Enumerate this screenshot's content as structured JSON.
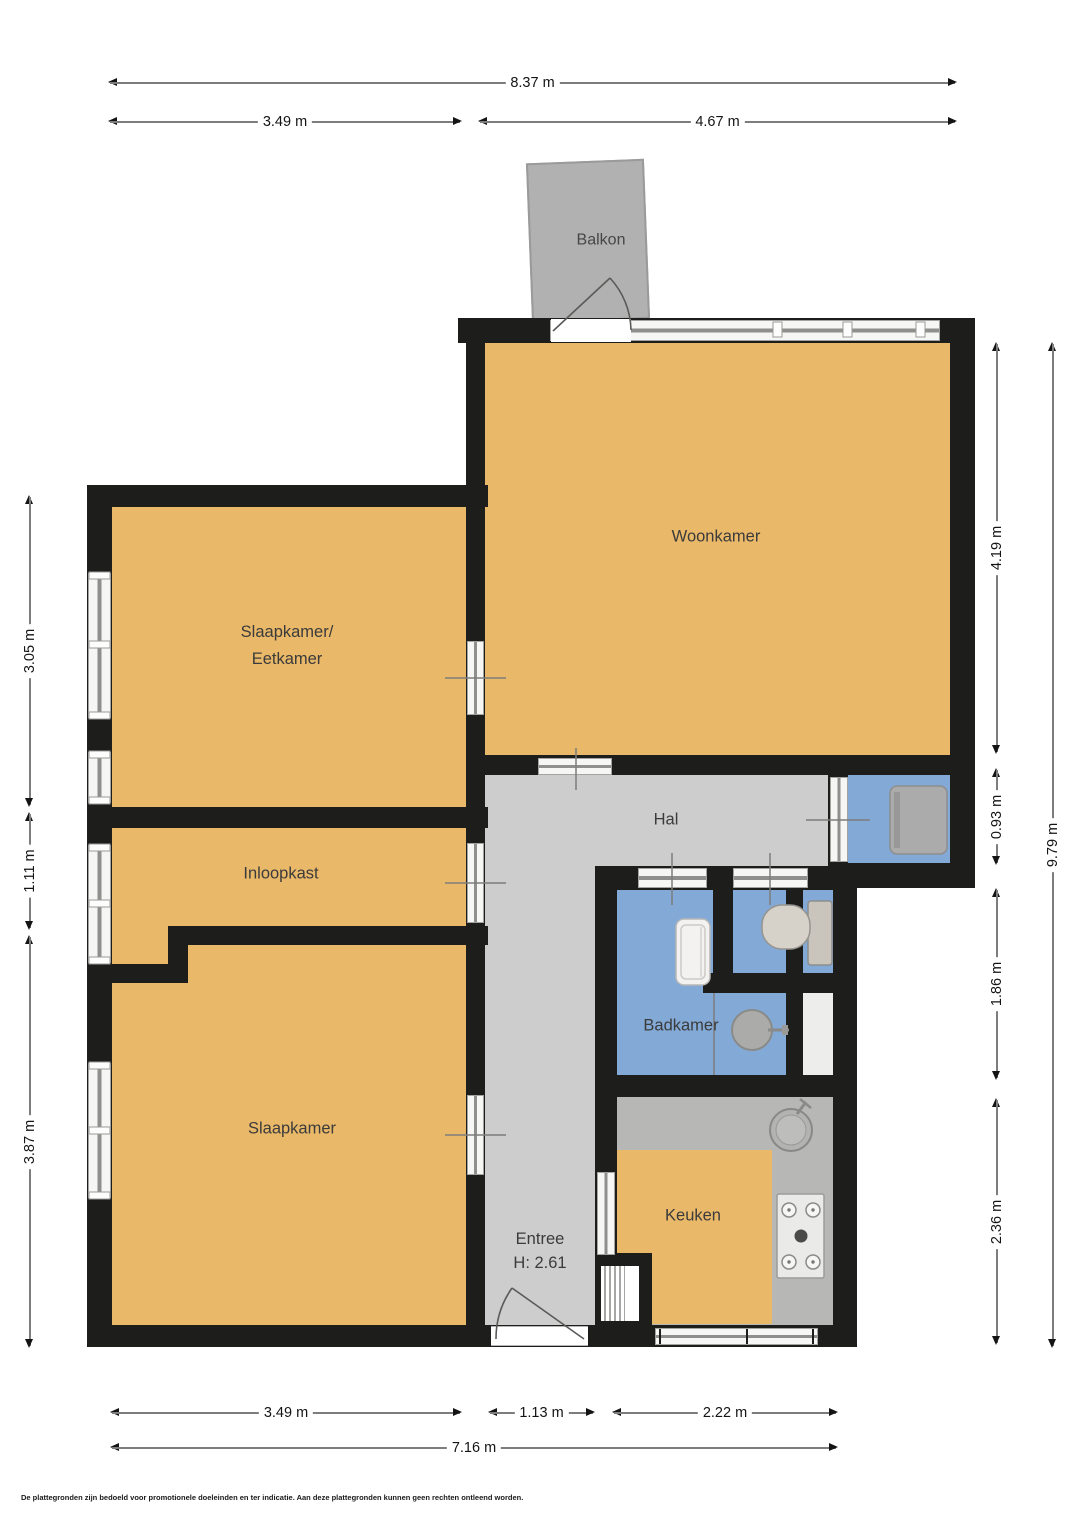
{
  "rooms": {
    "balkon": "Balkon",
    "woonkamer": "Woonkamer",
    "slaapkamer_eetkamer_line1": "Slaapkamer/",
    "slaapkamer_eetkamer_line2": "Eetkamer",
    "inloopkast": "Inloopkast",
    "slaapkamer": "Slaapkamer",
    "hal": "Hal",
    "badkamer": "Badkamer",
    "keuken": "Keuken",
    "entree": "Entree",
    "entree_height": "H: 2.61"
  },
  "dims": {
    "top_total": "8.37 m",
    "top_left": "3.49 m",
    "top_right": "4.67 m",
    "left_top": "3.05 m",
    "left_middle": "1.11 m",
    "left_bottom": "3.87 m",
    "right_woonkamer": "4.19 m",
    "right_closet": "0.93 m",
    "right_badkamer": "1.86 m",
    "right_keuken": "2.36 m",
    "right_total": "9.79 m",
    "bottom_left": "3.49 m",
    "bottom_middle": "1.13 m",
    "bottom_right": "2.22 m",
    "bottom_total": "7.16 m"
  },
  "colors": {
    "room_fill": "#e9b869",
    "wet_room_fill": "#83aad6",
    "hall_fill": "#cdcdcd",
    "counter_fill": "#b7b7b5",
    "balcony_fill": "#b1b1b1",
    "wall": "#1d1d1b"
  },
  "disclaimer": "De plattegronden zijn bedoeld voor promotionele doeleinden en ter indicatie. Aan deze plattegronden kunnen geen rechten ontleend worden."
}
